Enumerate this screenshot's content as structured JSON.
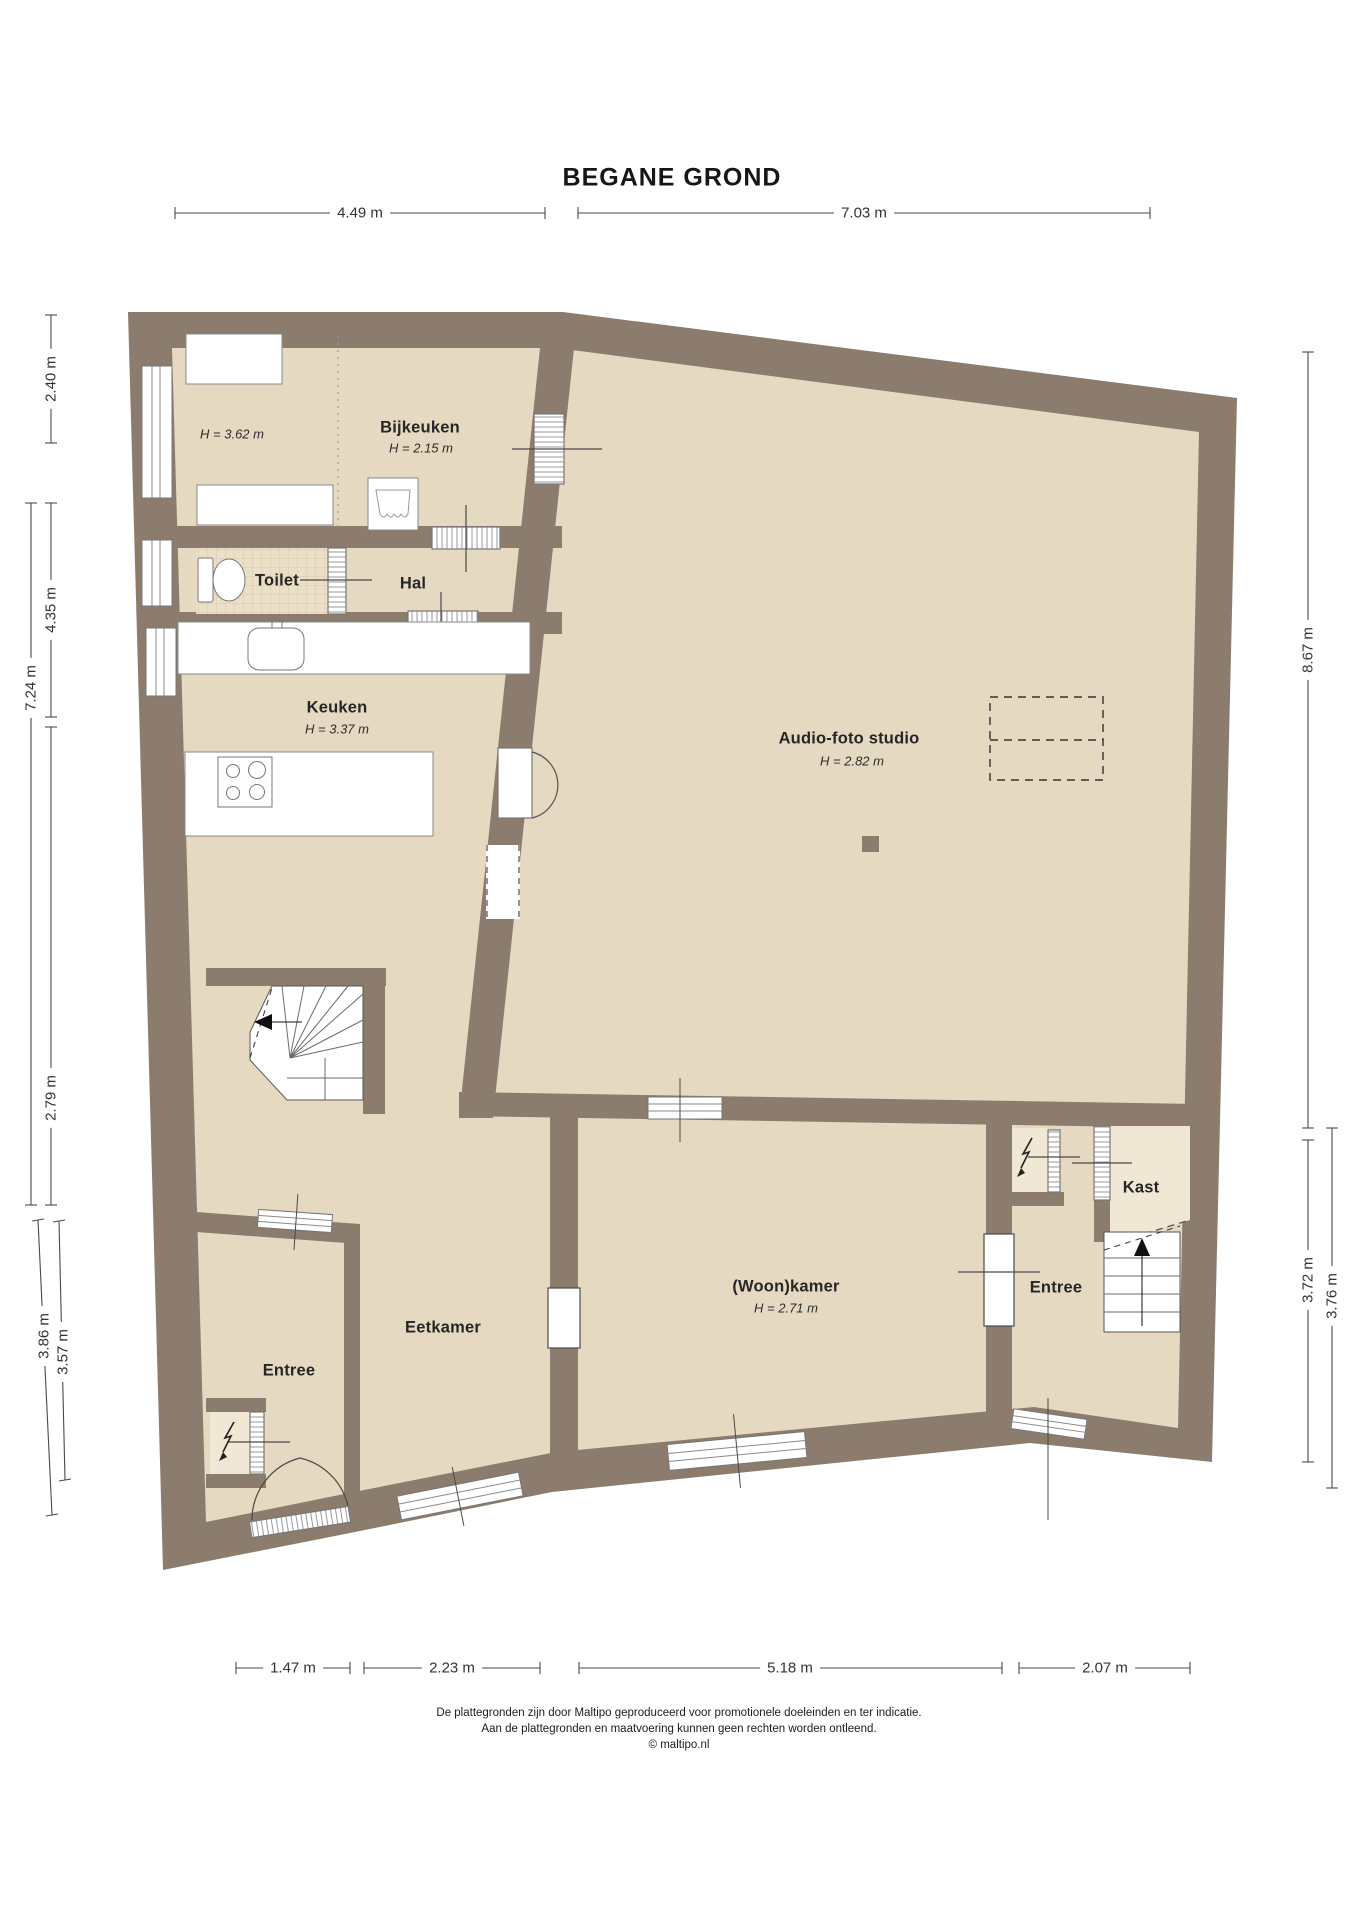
{
  "title": "BEGANE GROND",
  "rooms": {
    "area_left": {
      "height": "H = 3.62 m"
    },
    "bijkeuken": {
      "name": "Bijkeuken",
      "height": "H = 2.15 m"
    },
    "toilet": {
      "name": "Toilet"
    },
    "hal": {
      "name": "Hal"
    },
    "keuken": {
      "name": "Keuken",
      "height": "H = 3.37 m"
    },
    "studio": {
      "name": "Audio-foto studio",
      "height": "H = 2.82 m"
    },
    "eetkamer": {
      "name": "Eetkamer"
    },
    "entree_left": {
      "name": "Entree"
    },
    "woonkamer": {
      "name": "(Woon)kamer",
      "height": "H = 2.71 m"
    },
    "entree_right": {
      "name": "Entree"
    },
    "kast": {
      "name": "Kast"
    }
  },
  "dimensions": {
    "top": [
      "4.49 m",
      "7.03 m"
    ],
    "left": [
      "2.40 m",
      "4.35 m",
      "7.24 m",
      "2.79 m",
      "3.86 m",
      "3.57 m"
    ],
    "right": [
      "8.67 m",
      "3.72 m",
      "3.76 m"
    ],
    "bottom": [
      "1.47 m",
      "2.23 m",
      "5.18 m",
      "2.07 m"
    ]
  },
  "footer": {
    "line1": "De plattegronden zijn door Maltipo geproduceerd voor promotionele doeleinden en ter indicatie.",
    "line2": "Aan de plattegronden en maatvoering kunnen geen rechten worden ontleend.",
    "line3": "© maltipo.nl"
  },
  "colors": {
    "wall": "#8b7c6e",
    "floor": "#e6d9c2",
    "tile_floor": "#ecdfc8",
    "closet_floor": "#f0e7d4",
    "dimension_line": "#4a4a4a"
  }
}
